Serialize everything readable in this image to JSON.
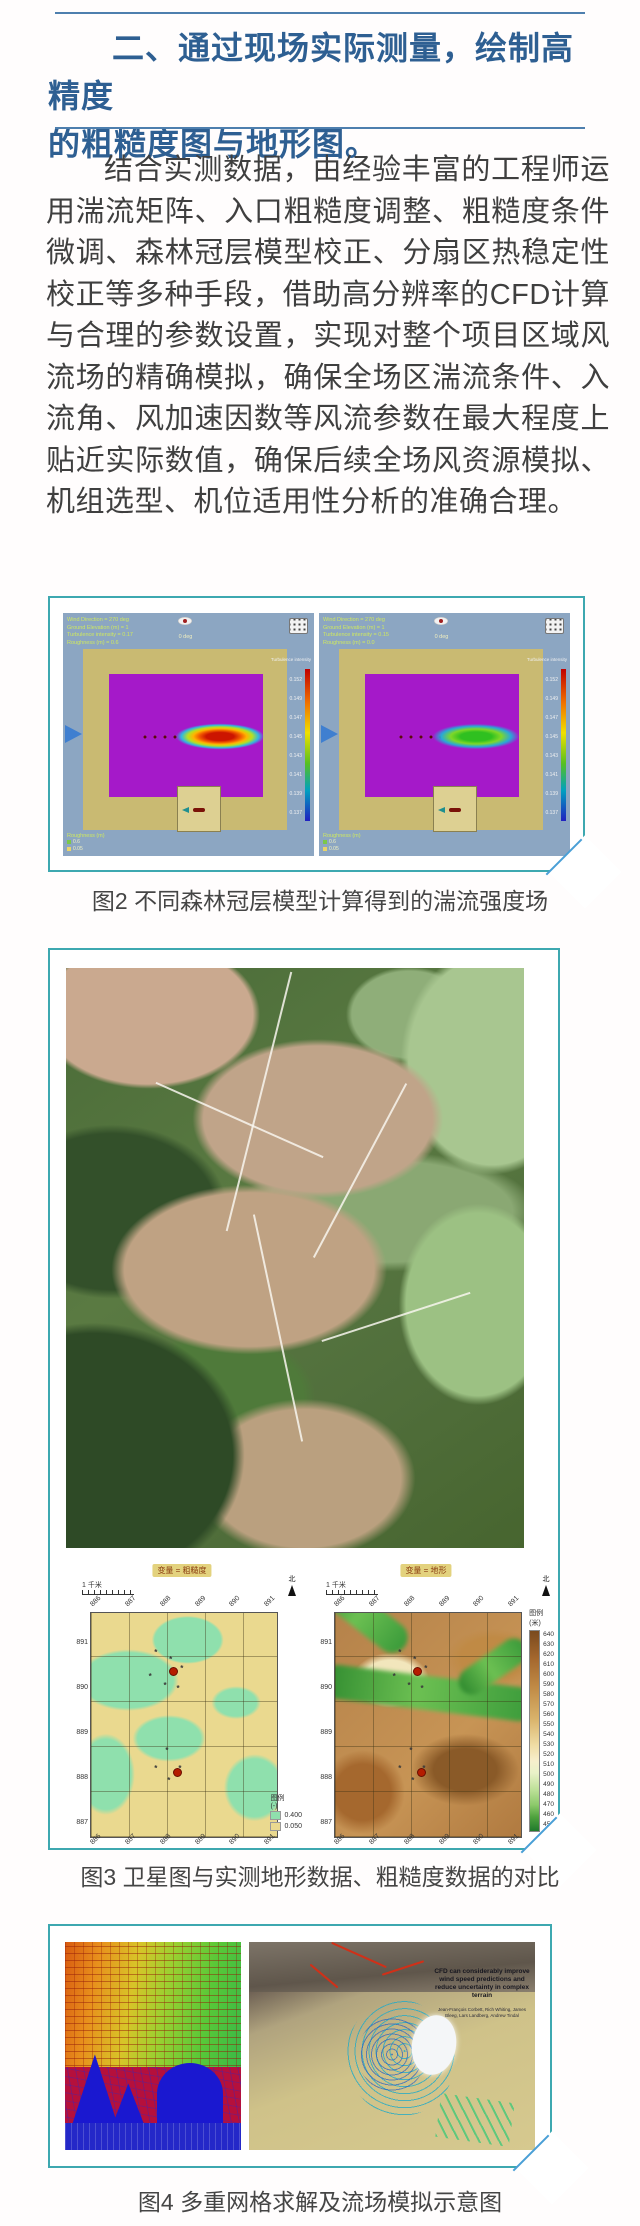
{
  "page": {
    "background": "#ffffff",
    "accent_blue": "#2e5f92",
    "rule_color": "#4e7fae",
    "frame_teal": "#3da8b0",
    "frame_fold_blue": "#4a9fd6"
  },
  "heading": {
    "line1": "二、通过现场实际测量，绘制高精度",
    "line2": "的粗糙度图与地形图。"
  },
  "paragraph": {
    "text": "结合实测数据，由经验丰富的工程师运用湍流矩阵、入口粗糙度调整、粗糙度条件微调、森林冠层模型校正、分扇区热稳定性校正等多种手段，借助高分辨率的CFD计算与合理的参数设置，实现对整个项目区域风流场的精确模拟，确保全场区湍流条件、入流角、风加速因数等风流参数在最大程度上贴近实际数值，确保后续全场风资源模拟、机组选型、机位适用性分析的准确合理。"
  },
  "figure2": {
    "caption": "图2 不同森林冠层模型计算得到的湍流强度场",
    "panel_bg": "#8ca6c2",
    "domain_color": "#a519c9",
    "ground_color": "#c9ba72",
    "panels": [
      {
        "info": "Wind Direction = 270 deg\nGround Elevation (m) = 1\nTurbulence intensity = 0.17\nRoughness (m) = 0.6",
        "compass_label": "0 deg",
        "colorbar_title": "Turbulence intensity",
        "colorbar_ticks": "0.152\n0.149\n0.147\n0.145\n0.143\n0.141\n0.139\n0.137",
        "legend_title": "Roughness (m)",
        "legend_items": [
          {
            "label": "0.6",
            "color": "#7bc84a"
          },
          {
            "label": "0.05",
            "color": "#e8d46a"
          }
        ],
        "plume_color": "red"
      },
      {
        "info": "Wind Direction = 270 deg\nGround Elevation (m) = 1\nTurbulence intensity = 0.15\nRoughness (m) = 0.0",
        "compass_label": "0 deg",
        "colorbar_title": "Turbulence intensity",
        "colorbar_ticks": "0.152\n0.149\n0.147\n0.145\n0.143\n0.141\n0.139\n0.137",
        "legend_title": "Roughness (m)",
        "legend_items": [
          {
            "label": "0.6",
            "color": "#7bc84a"
          },
          {
            "label": "0.05",
            "color": "#e8d46a"
          }
        ],
        "plume_color": "green"
      }
    ]
  },
  "figure3": {
    "caption": "图3 卫星图与实测地形数据、粗糙度数据的对比",
    "maps": [
      {
        "title": "变量 = 粗糙度",
        "scale_label": "1 千米",
        "north_label": "北",
        "x_ticks": [
          "886",
          "887",
          "888",
          "889",
          "890",
          "891"
        ],
        "y_ticks": "891\n890\n889\n888\n887",
        "legend_title": "图例",
        "legend_unit": "(-)",
        "legend_items": [
          {
            "label": "0.400",
            "color": "#8fe0ad"
          },
          {
            "label": "0.050",
            "color": "#ead98f"
          }
        ]
      },
      {
        "title": "变量 = 地形",
        "scale_label": "1 千米",
        "north_label": "北",
        "x_ticks": [
          "886",
          "887",
          "888",
          "889",
          "890",
          "891"
        ],
        "y_ticks": "891\n890\n889\n888\n887",
        "legend_title": "图例",
        "legend_unit": "(米)",
        "legend_values": "640\n630\n620\n610\n600\n590\n580\n570\n560\n550\n540\n530\n520\n510\n500\n490\n480\n470\n460\n450"
      }
    ]
  },
  "figure4": {
    "caption": "图4 多重网格求解及流场模拟示意图",
    "right_text_title": "CFD can considerably improve wind speed predictions and reduce uncertainty in complex terrain",
    "right_text_authors": "Jean-François Corbett, Rich Whiting, James Bleeg, Lars Landberg, Andrew Tindal"
  }
}
